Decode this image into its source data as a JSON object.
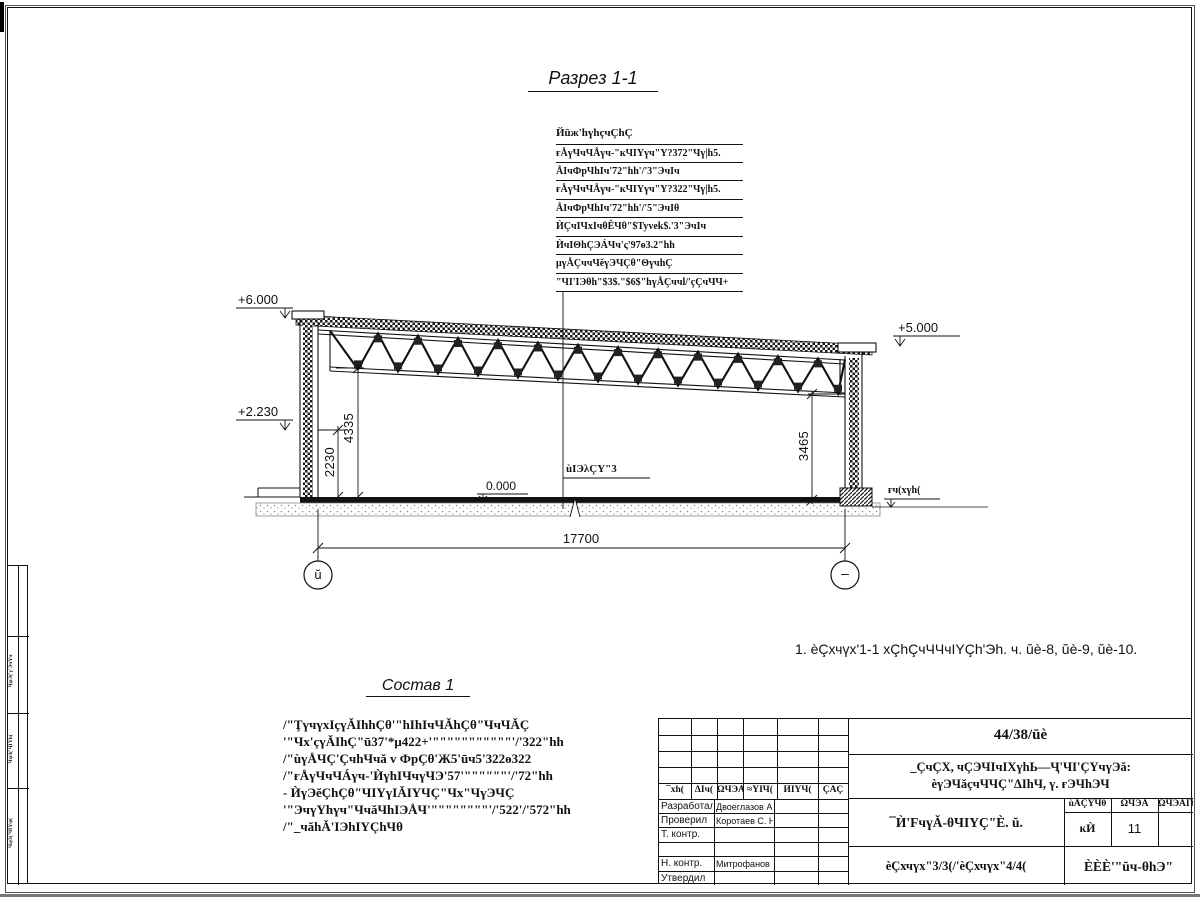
{
  "drawing": {
    "section_title": "Разрез 1-1",
    "callout": {
      "header": "Йūж'hүhçчÇhÇ",
      "rows": [
        "ғÅүЧчЧÅүч-\"кЧIYүч\"Y?372\"Чү|h5.",
        "ÅIчФрЧhIч'72\"hh'/'3\"ЭчIч",
        "ғÅүЧчЧÅүч-\"кЧIYүч\"Y?322\"Чү|h5.",
        "ÅIчФрЧhIч'72\"hh'/'5\"ЭчIθ",
        "ЍÇчIЧхIчθÊЧθ\"$Tyvek$.'3\"ЭчIч",
        "ЍчIΘhÇЭÁЧч'ς'97ө3.2\"hh",
        "μүÅÇччЧĕүЭЧÇθ\"ΘүчhÇ",
        "\"ЧI'IЭθh\"$3$.\"$6$\"hүÅÇччl/'çÇчЧЧ+"
      ]
    },
    "elevations": {
      "top_left": "+6.000",
      "mid_left": "+2.230",
      "top_right": "+5.000",
      "floor_zero": "0.000",
      "ground": "ғч(хүh("
    },
    "dimensions": {
      "left_inner": "2230",
      "left_truss": "4335",
      "right_truss": "3465",
      "span": "17700"
    },
    "floor_label": "ùIЭλÇY\"3",
    "axes": {
      "left": "ŭ",
      "right": "–"
    }
  },
  "note": {
    "text": "1. èÇхчүх'1-1 хÇhÇчЧЧчIYÇh'Эh. ч. ŭè-8, ŭè-9, ŭè-10."
  },
  "sostav": {
    "title": "Состав 1",
    "lines": [
      "/\"ŢүчүхIçүǍIhhÇθ'\"hIhIчЧǍhÇθ\"ЧчЧǍÇ",
      "'\"Чх'çүǍIhÇ\"ū37'*μ422+'\"\"\"\"\"\"\"\"\"\"\"'/'322\"hh",
      "/\"ùүÅЧÇ'ÇчhЧчă v ФрÇθ'Ж5'ūч5'322ө322",
      "/\"ғÅүЧчЧÁүч-'ЍүhIЧчүЧЭ'57'\"\"\"\"\"\"'/'72\"hh",
      "- ЍүЭĕÇhÇθ\"ЧIYүIǍIYЧÇ\"Чх\"ЧүЭЧÇ",
      "'\"ЭчүYhүч\"ЧчăЧhIЭÅЧ'\"\"\"\"\"\"\"\"'/'522'/'572\"hh",
      "/\"_чăhǍ'IЭhIYÇhЧθ"
    ]
  },
  "title_block": {
    "doc_number": "44/38/ūè",
    "project_line1": "_ÇчÇХ, чÇЭЧIчIХүhЬ—Ҷ'ЧI'ÇYчүЭă:",
    "project_line2": "èүЭЧăçчЧЧÇ\"ΔIhЧ, ү. ғЭЧhЭЧ",
    "object_name": "¯Ѝ'FчүǍ-θЧIYÇ\"È. ŭ.",
    "sheet_caption": "èÇхчүх\"3/3(/'èÇхчүх\"4/4(",
    "stage_header": "ùǍÇYЧθ",
    "list_header": "ΩЧЭǍ",
    "lists_header": "ΩЧЭǍIY",
    "stage_value": "ĸЍ",
    "list_value": "11",
    "lists_value": "",
    "company": "ÈÈÈ'\"ŭч-θhЭ\"",
    "rev_headers": [
      "¯хh(",
      "ΔIч(",
      "ΩЧЭǍ",
      "≈YIЧ(",
      "ЍIYЧ(",
      "ÇǍÇ"
    ],
    "rows": [
      {
        "role": "Разработал",
        "name": "Двоеглазов А. В."
      },
      {
        "role": "Проверил",
        "name": "Коротаев С. Н."
      },
      {
        "role": "Т. контр.",
        "name": ""
      },
      {
        "role": "",
        "name": ""
      },
      {
        "role": "Н. контр.",
        "name": "Митрофанов Я. А."
      },
      {
        "role": "Утвердил",
        "name": ""
      }
    ]
  },
  "frame": {
    "margin_labels": [
      "ҶψЭ('γ'ЭчYч",
      "ЧψӞ('ҶIYh(",
      "ЧψӞ('ЧIYψ("
    ]
  }
}
